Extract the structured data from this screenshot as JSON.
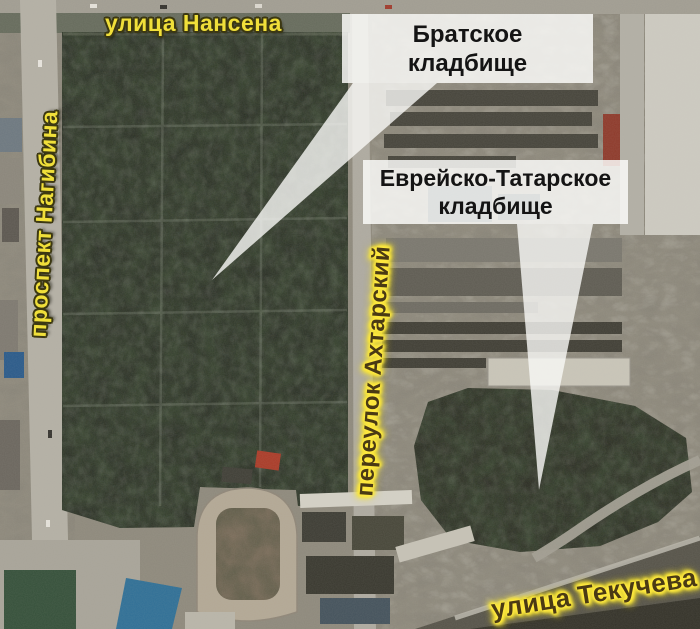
{
  "map": {
    "street_labels": [
      {
        "id": "nansena",
        "text": "улица Нансена",
        "orientation": "horizontal"
      },
      {
        "id": "nagibina",
        "text": "проспект Нагибина",
        "orientation": "vertical"
      },
      {
        "id": "akhtarsky",
        "text": "переулок Ахтарский",
        "orientation": "vertical"
      },
      {
        "id": "tekucheva",
        "text": "улица Текучева",
        "orientation": "diagonal"
      }
    ],
    "callouts": [
      {
        "id": "bratskoe",
        "line1": "Братское",
        "line2": "кладбище"
      },
      {
        "id": "jewish-tatar",
        "line1": "Еврейско-Татарское",
        "line2": "кладбище"
      }
    ],
    "colors": {
      "street_label_yellow": "#f0df3a",
      "street_label_outline": "#3c3812",
      "street_label_dark_text": "#4a3a14",
      "street_label_glow": "#ffe940",
      "callout_background": "rgba(251,251,249,0.84)",
      "callout_text": "#141414",
      "trees_dark": "#2b3026",
      "road_gray": "#b4b0a5"
    }
  }
}
